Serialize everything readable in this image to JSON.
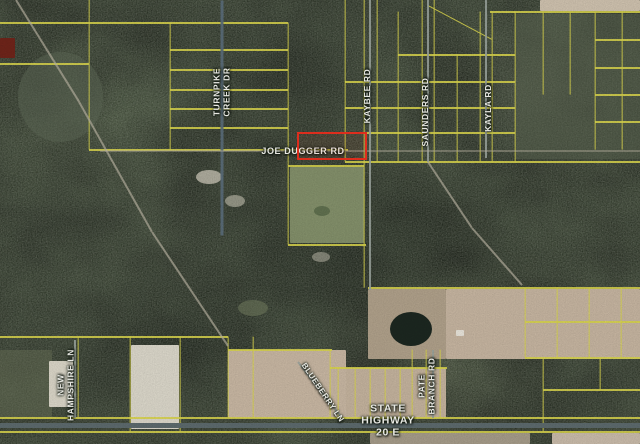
{
  "map": {
    "type": "aerial-parcel-map",
    "colors": {
      "parcel": "#d6d14c",
      "road": "#99a29b",
      "road_dark": "#5a6b78",
      "highway": "#5c696c",
      "trail": "#b7b1a0",
      "highlight": "#e8301f",
      "label_text": "#f4f4ee",
      "forest_base": "#47533f",
      "field_tan": "#c6b5a1"
    },
    "highlight": {
      "x": 297,
      "y": 132,
      "w": 66,
      "h": 24,
      "border": 2
    },
    "labels": [
      {
        "id": "turnpike-creek-dr",
        "text": "TURNPIKE CREEK DR",
        "lines": [
          "TURNPIKE",
          "CREEK DR"
        ],
        "x": 222,
        "y": 92,
        "rot": -90,
        "size": 8.5
      },
      {
        "id": "joe-dugger-rd",
        "text": "JOE DUGGER RD",
        "lines": [
          "JOE DUGGER RD"
        ],
        "x": 303,
        "y": 151,
        "rot": 0,
        "size": 9
      },
      {
        "id": "kaybee-rd",
        "text": "KAYBEE RD",
        "lines": [
          "KAYBEE RD"
        ],
        "x": 368,
        "y": 96,
        "rot": -90,
        "size": 8.5
      },
      {
        "id": "saunders-rd",
        "text": "SAUNDERS RD",
        "lines": [
          "SAUNDERS RD"
        ],
        "x": 426,
        "y": 112,
        "rot": -90,
        "size": 8.5
      },
      {
        "id": "kayla-rd",
        "text": "KAYLA RD",
        "lines": [
          "KAYLA RD"
        ],
        "x": 489,
        "y": 108,
        "rot": -90,
        "size": 8.5
      },
      {
        "id": "new-hampshire-ln",
        "text": "NEW HAMPSHIRE LN",
        "lines": [
          "NEW",
          "HAMPSHIRE LN"
        ],
        "x": 66,
        "y": 385,
        "rot": -90,
        "size": 8.5
      },
      {
        "id": "blueberry-ln",
        "text": "BLUEBERRY LN",
        "lines": [
          "BLUEBERRY LN"
        ],
        "x": 322,
        "y": 393,
        "rot": 56,
        "size": 8
      },
      {
        "id": "pate-branch-rd",
        "text": "PATE BRANCH RD",
        "lines": [
          "PATE",
          "BRANCH RD"
        ],
        "x": 427,
        "y": 386,
        "rot": -90,
        "size": 8.5
      },
      {
        "id": "state-highway-20-e",
        "text": "STATE HIGHWAY 20 E",
        "lines": [
          "STATE",
          "HIGHWAY",
          "20 E"
        ],
        "x": 388,
        "y": 421,
        "rot": 0,
        "size": 10.5
      }
    ],
    "segments": [
      [
        "parcel",
        0,
        23,
        288,
        23
      ],
      [
        "parcel",
        170,
        50,
        288,
        50
      ],
      [
        "parcel",
        170,
        70,
        288,
        70
      ],
      [
        "parcel",
        170,
        90,
        288,
        90
      ],
      [
        "parcel",
        170,
        109,
        288,
        109
      ],
      [
        "parcel",
        170,
        128,
        288,
        128
      ],
      [
        "parcel",
        89,
        150,
        348,
        150
      ],
      [
        "parcel",
        345,
        162,
        640,
        162
      ],
      [
        "parcel",
        490,
        12,
        640,
        12
      ],
      [
        "parcel",
        345,
        82,
        515,
        82
      ],
      [
        "parcel",
        345,
        108,
        515,
        108
      ],
      [
        "parcel",
        345,
        133,
        515,
        133
      ],
      [
        "parcel",
        398,
        55,
        515,
        55
      ],
      [
        "parcel",
        595,
        40,
        640,
        40
      ],
      [
        "parcel",
        595,
        68,
        640,
        68
      ],
      [
        "parcel",
        595,
        95,
        640,
        95
      ],
      [
        "parcel",
        595,
        122,
        640,
        122
      ],
      [
        "parcel",
        368,
        288,
        640,
        288
      ],
      [
        "parcel",
        525,
        322,
        640,
        322
      ],
      [
        "parcel",
        525,
        358,
        640,
        358
      ],
      [
        "parcel",
        543,
        390,
        640,
        390
      ],
      [
        "parcel",
        0,
        337,
        228,
        337
      ],
      [
        "parcel",
        228,
        350,
        332,
        350
      ],
      [
        "parcel",
        330,
        368,
        447,
        368
      ],
      [
        "parcel",
        0,
        418,
        640,
        418
      ],
      [
        "parcel",
        0,
        432,
        640,
        432
      ],
      [
        "parcel",
        288,
        245,
        366,
        245
      ],
      [
        "parcel",
        288,
        166,
        364,
        166
      ],
      [
        "parcel",
        0,
        64,
        89,
        64
      ],
      [
        "parcel",
        89,
        0,
        89,
        150
      ],
      [
        "parcel",
        170,
        23,
        170,
        150
      ],
      [
        "parcel",
        288,
        23,
        288,
        245
      ],
      [
        "parcel",
        345,
        0,
        345,
        162
      ],
      [
        "parcel",
        364,
        0,
        364,
        288
      ],
      [
        "parcel",
        377,
        0,
        377,
        162
      ],
      [
        "parcel",
        398,
        12,
        398,
        162
      ],
      [
        "parcel",
        422,
        0,
        422,
        162
      ],
      [
        "parcel",
        434,
        0,
        434,
        162
      ],
      [
        "parcel",
        457,
        55,
        457,
        162
      ],
      [
        "parcel",
        480,
        12,
        480,
        162
      ],
      [
        "parcel",
        492,
        12,
        492,
        162
      ],
      [
        "parcel",
        515,
        12,
        515,
        162
      ],
      [
        "parcel",
        543,
        12,
        543,
        95
      ],
      [
        "parcel",
        570,
        12,
        570,
        95
      ],
      [
        "parcel",
        595,
        12,
        595,
        150
      ],
      [
        "parcel",
        622,
        12,
        622,
        150
      ],
      [
        "parcel",
        428,
        6,
        492,
        40
      ],
      [
        "parcel",
        525,
        288,
        525,
        358
      ],
      [
        "parcel",
        557,
        288,
        557,
        358
      ],
      [
        "parcel",
        589,
        288,
        589,
        358
      ],
      [
        "parcel",
        621,
        288,
        621,
        358
      ],
      [
        "parcel",
        543,
        358,
        543,
        432
      ],
      [
        "parcel",
        600,
        358,
        600,
        390
      ],
      [
        "parcel",
        228,
        337,
        228,
        418
      ],
      [
        "parcel",
        253,
        337,
        253,
        418
      ],
      [
        "parcel",
        130,
        337,
        130,
        432
      ],
      [
        "parcel",
        180,
        337,
        180,
        432
      ],
      [
        "parcel",
        78,
        337,
        78,
        418
      ],
      [
        "parcel",
        330,
        350,
        330,
        418
      ],
      [
        "parcel",
        338,
        368,
        338,
        418
      ],
      [
        "parcel",
        355,
        368,
        355,
        418
      ],
      [
        "parcel",
        370,
        368,
        370,
        418
      ],
      [
        "parcel",
        385,
        368,
        385,
        418
      ],
      [
        "parcel",
        400,
        368,
        400,
        418
      ],
      [
        "parcel",
        412,
        350,
        412,
        418
      ],
      [
        "parcel",
        426,
        350,
        426,
        418
      ],
      [
        "parcel",
        440,
        350,
        440,
        418
      ],
      [
        "road_dark",
        222,
        0,
        222,
        235
      ],
      [
        "road",
        370,
        0,
        370,
        290
      ],
      [
        "road",
        428,
        0,
        428,
        162
      ],
      [
        "road",
        486,
        0,
        486,
        158
      ],
      [
        "highway",
        0,
        425,
        640,
        425
      ],
      [
        "road",
        75,
        340,
        75,
        418
      ],
      [
        "road",
        298,
        362,
        342,
        418
      ],
      [
        "road",
        433,
        350,
        433,
        418
      ],
      [
        "trail",
        16,
        0,
        78,
        100
      ],
      [
        "trail",
        78,
        100,
        152,
        232
      ],
      [
        "trail",
        152,
        232,
        228,
        346
      ],
      [
        "trail",
        428,
        162,
        472,
        228
      ],
      [
        "trail",
        472,
        228,
        522,
        285
      ],
      [
        "trail",
        100,
        151,
        640,
        151,
        2,
        0.45
      ]
    ],
    "patches": [
      {
        "name": "light-terrain",
        "x": 18,
        "y": 52,
        "w": 85,
        "h": 90,
        "color": "#5d6755",
        "opacity": 0.55,
        "round": true
      },
      {
        "name": "light-terrain",
        "x": 515,
        "y": 14,
        "w": 125,
        "h": 145,
        "color": "#59644f",
        "opacity": 0.5
      },
      {
        "name": "light-terrain",
        "x": 0,
        "y": 350,
        "w": 52,
        "h": 68,
        "color": "#6a7258",
        "opacity": 0.5
      },
      {
        "name": "grass-parcel",
        "x": 290,
        "y": 167,
        "w": 74,
        "h": 76,
        "color": "#8e9b72",
        "opacity": 0.85
      },
      {
        "name": "pond-small",
        "x": 314,
        "y": 206,
        "w": 16,
        "h": 10,
        "color": "#5f6f4e",
        "round": true
      },
      {
        "name": "clearing",
        "x": 196,
        "y": 170,
        "w": 26,
        "h": 14,
        "color": "#cfcabb",
        "opacity": 0.75,
        "round": true
      },
      {
        "name": "clearing",
        "x": 225,
        "y": 195,
        "w": 20,
        "h": 12,
        "color": "#c8c4b4",
        "opacity": 0.6,
        "round": true
      },
      {
        "name": "clearing",
        "x": 312,
        "y": 252,
        "w": 18,
        "h": 10,
        "color": "#c8c4b4",
        "opacity": 0.5,
        "round": true
      },
      {
        "name": "clearing",
        "x": 238,
        "y": 300,
        "w": 30,
        "h": 16,
        "color": "#6f7a5e",
        "opacity": 0.6,
        "round": true
      },
      {
        "name": "field-top-right",
        "x": 540,
        "y": 0,
        "w": 100,
        "h": 11,
        "color": "#cdc0ad",
        "field": true
      },
      {
        "name": "red-roof-structure",
        "x": 0,
        "y": 38,
        "w": 15,
        "h": 20,
        "color": "#6e241a"
      },
      {
        "name": "field-mid-right",
        "x": 368,
        "y": 289,
        "w": 78,
        "h": 70,
        "color": "#ae9f89",
        "field": true
      },
      {
        "name": "field-bottom-right",
        "x": 446,
        "y": 289,
        "w": 194,
        "h": 70,
        "color": "#c4b39f",
        "field": true
      },
      {
        "name": "pond",
        "x": 390,
        "y": 312,
        "w": 42,
        "h": 34,
        "color": "#1c2720",
        "round": true
      },
      {
        "name": "structure",
        "x": 456,
        "y": 330,
        "w": 8,
        "h": 6,
        "color": "#e6e2d8"
      },
      {
        "name": "field-bottom-center",
        "x": 228,
        "y": 350,
        "w": 118,
        "h": 68,
        "color": "#c6b5a1",
        "field": true
      },
      {
        "name": "field-bottom-center-right",
        "x": 346,
        "y": 368,
        "w": 100,
        "h": 50,
        "color": "#c2b19c",
        "field": true
      },
      {
        "name": "cleared-parcel",
        "x": 131,
        "y": 345,
        "w": 48,
        "h": 84,
        "color": "#d9d5c8"
      },
      {
        "name": "cleared-parcel",
        "x": 49,
        "y": 361,
        "w": 24,
        "h": 46,
        "color": "#d8d4c6"
      },
      {
        "name": "field-below-highway",
        "x": 552,
        "y": 433,
        "w": 88,
        "h": 11,
        "color": "#c7b9a8",
        "field": true
      },
      {
        "name": "field-below-highway",
        "x": 370,
        "y": 433,
        "w": 160,
        "h": 11,
        "color": "#b5a895",
        "opacity": 0.85,
        "field": true
      }
    ]
  }
}
